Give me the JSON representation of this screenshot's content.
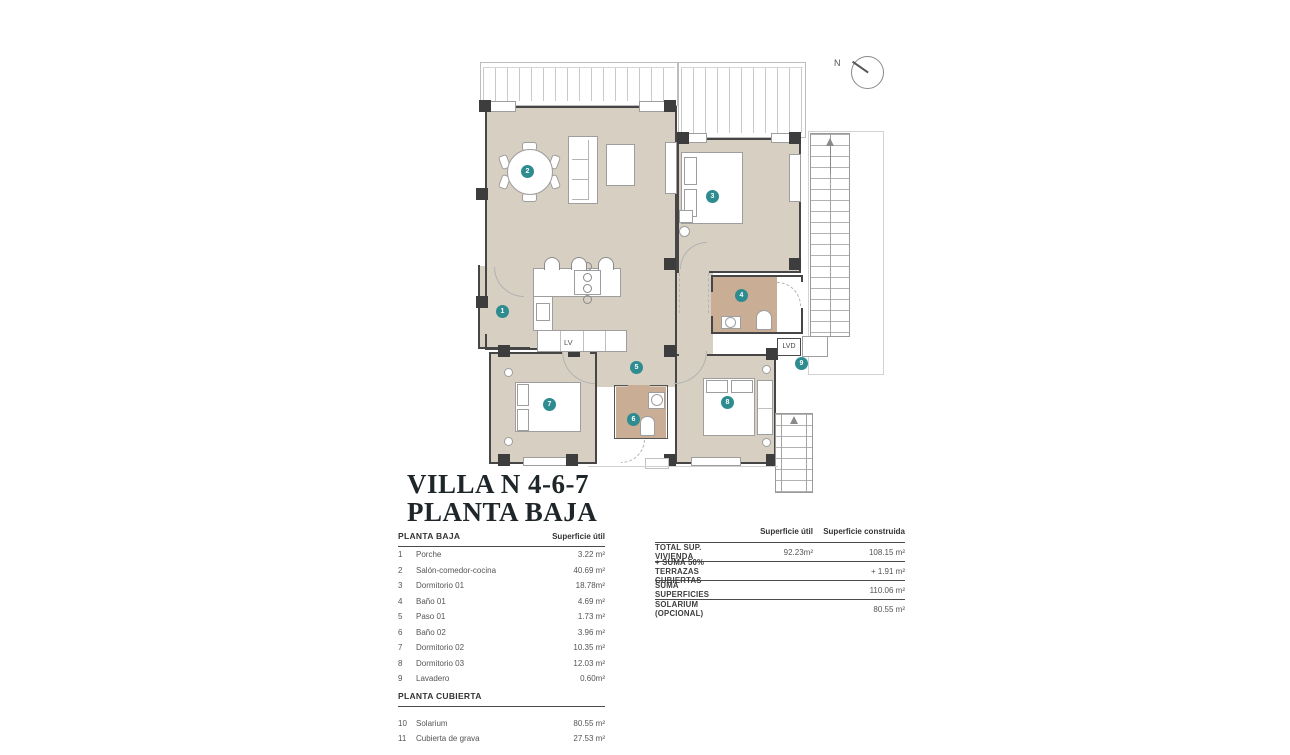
{
  "title": {
    "line1": "VILLA N 4-6-7",
    "line2": "PLANTA BAJA"
  },
  "compass": {
    "label": "N"
  },
  "colors": {
    "floor_beige": "#d7cfc2",
    "bath_tan": "#c9ad94",
    "label_teal": "#2e8c90",
    "wall_dark": "#464646",
    "text_dark": "#1f262a"
  },
  "plan": {
    "labels": [
      "1",
      "2",
      "3",
      "4",
      "5",
      "6",
      "7",
      "8",
      "9"
    ],
    "kitchen_lv": "LV",
    "lvd": "LVD"
  },
  "left_table": {
    "planta_baja": {
      "title": "PLANTA BAJA",
      "col_header": "Superficie útil",
      "rows": [
        {
          "num": "1",
          "name": "Porche",
          "value": "3.22 m²"
        },
        {
          "num": "2",
          "name": "Salón-comedor-cocina",
          "value": "40.69 m²"
        },
        {
          "num": "3",
          "name": "Dormitorio 01",
          "value": "18.78m²"
        },
        {
          "num": "4",
          "name": "Baño 01",
          "value": "4.69 m²"
        },
        {
          "num": "5",
          "name": "Paso 01",
          "value": "1.73 m²"
        },
        {
          "num": "6",
          "name": "Baño 02",
          "value": "3.96 m²"
        },
        {
          "num": "7",
          "name": "Dormitorio 02",
          "value": "10.35 m²"
        },
        {
          "num": "8",
          "name": "Dormitorio 03",
          "value": "12.03 m²"
        },
        {
          "num": "9",
          "name": "Lavadero",
          "value": "0.60m²"
        }
      ]
    },
    "planta_cubierta": {
      "title": "PLANTA CUBIERTA",
      "rows": [
        {
          "num": "10",
          "name": "Solarium",
          "value": "80.55 m²"
        },
        {
          "num": "11",
          "name": "Cubierta de grava",
          "value": "27.53 m²"
        }
      ]
    }
  },
  "right_table": {
    "col1_header": "Superficie útil",
    "col2_header": "Superficie construida",
    "rows": [
      {
        "label": "TOTAL SUP. VIVIENDA",
        "util": "92.23m²",
        "built": "108.15 m²"
      },
      {
        "label": "+ SUMA 50% TERRAZAS CUBIERTAS",
        "util": "",
        "built": "+ 1.91 m²"
      },
      {
        "label": "SUMA SUPERFICIES",
        "util": "",
        "built": "110.06 m²"
      },
      {
        "label": "SOLARIUM (OPCIONAL)",
        "util": "",
        "built": "80.55 m²"
      }
    ]
  }
}
